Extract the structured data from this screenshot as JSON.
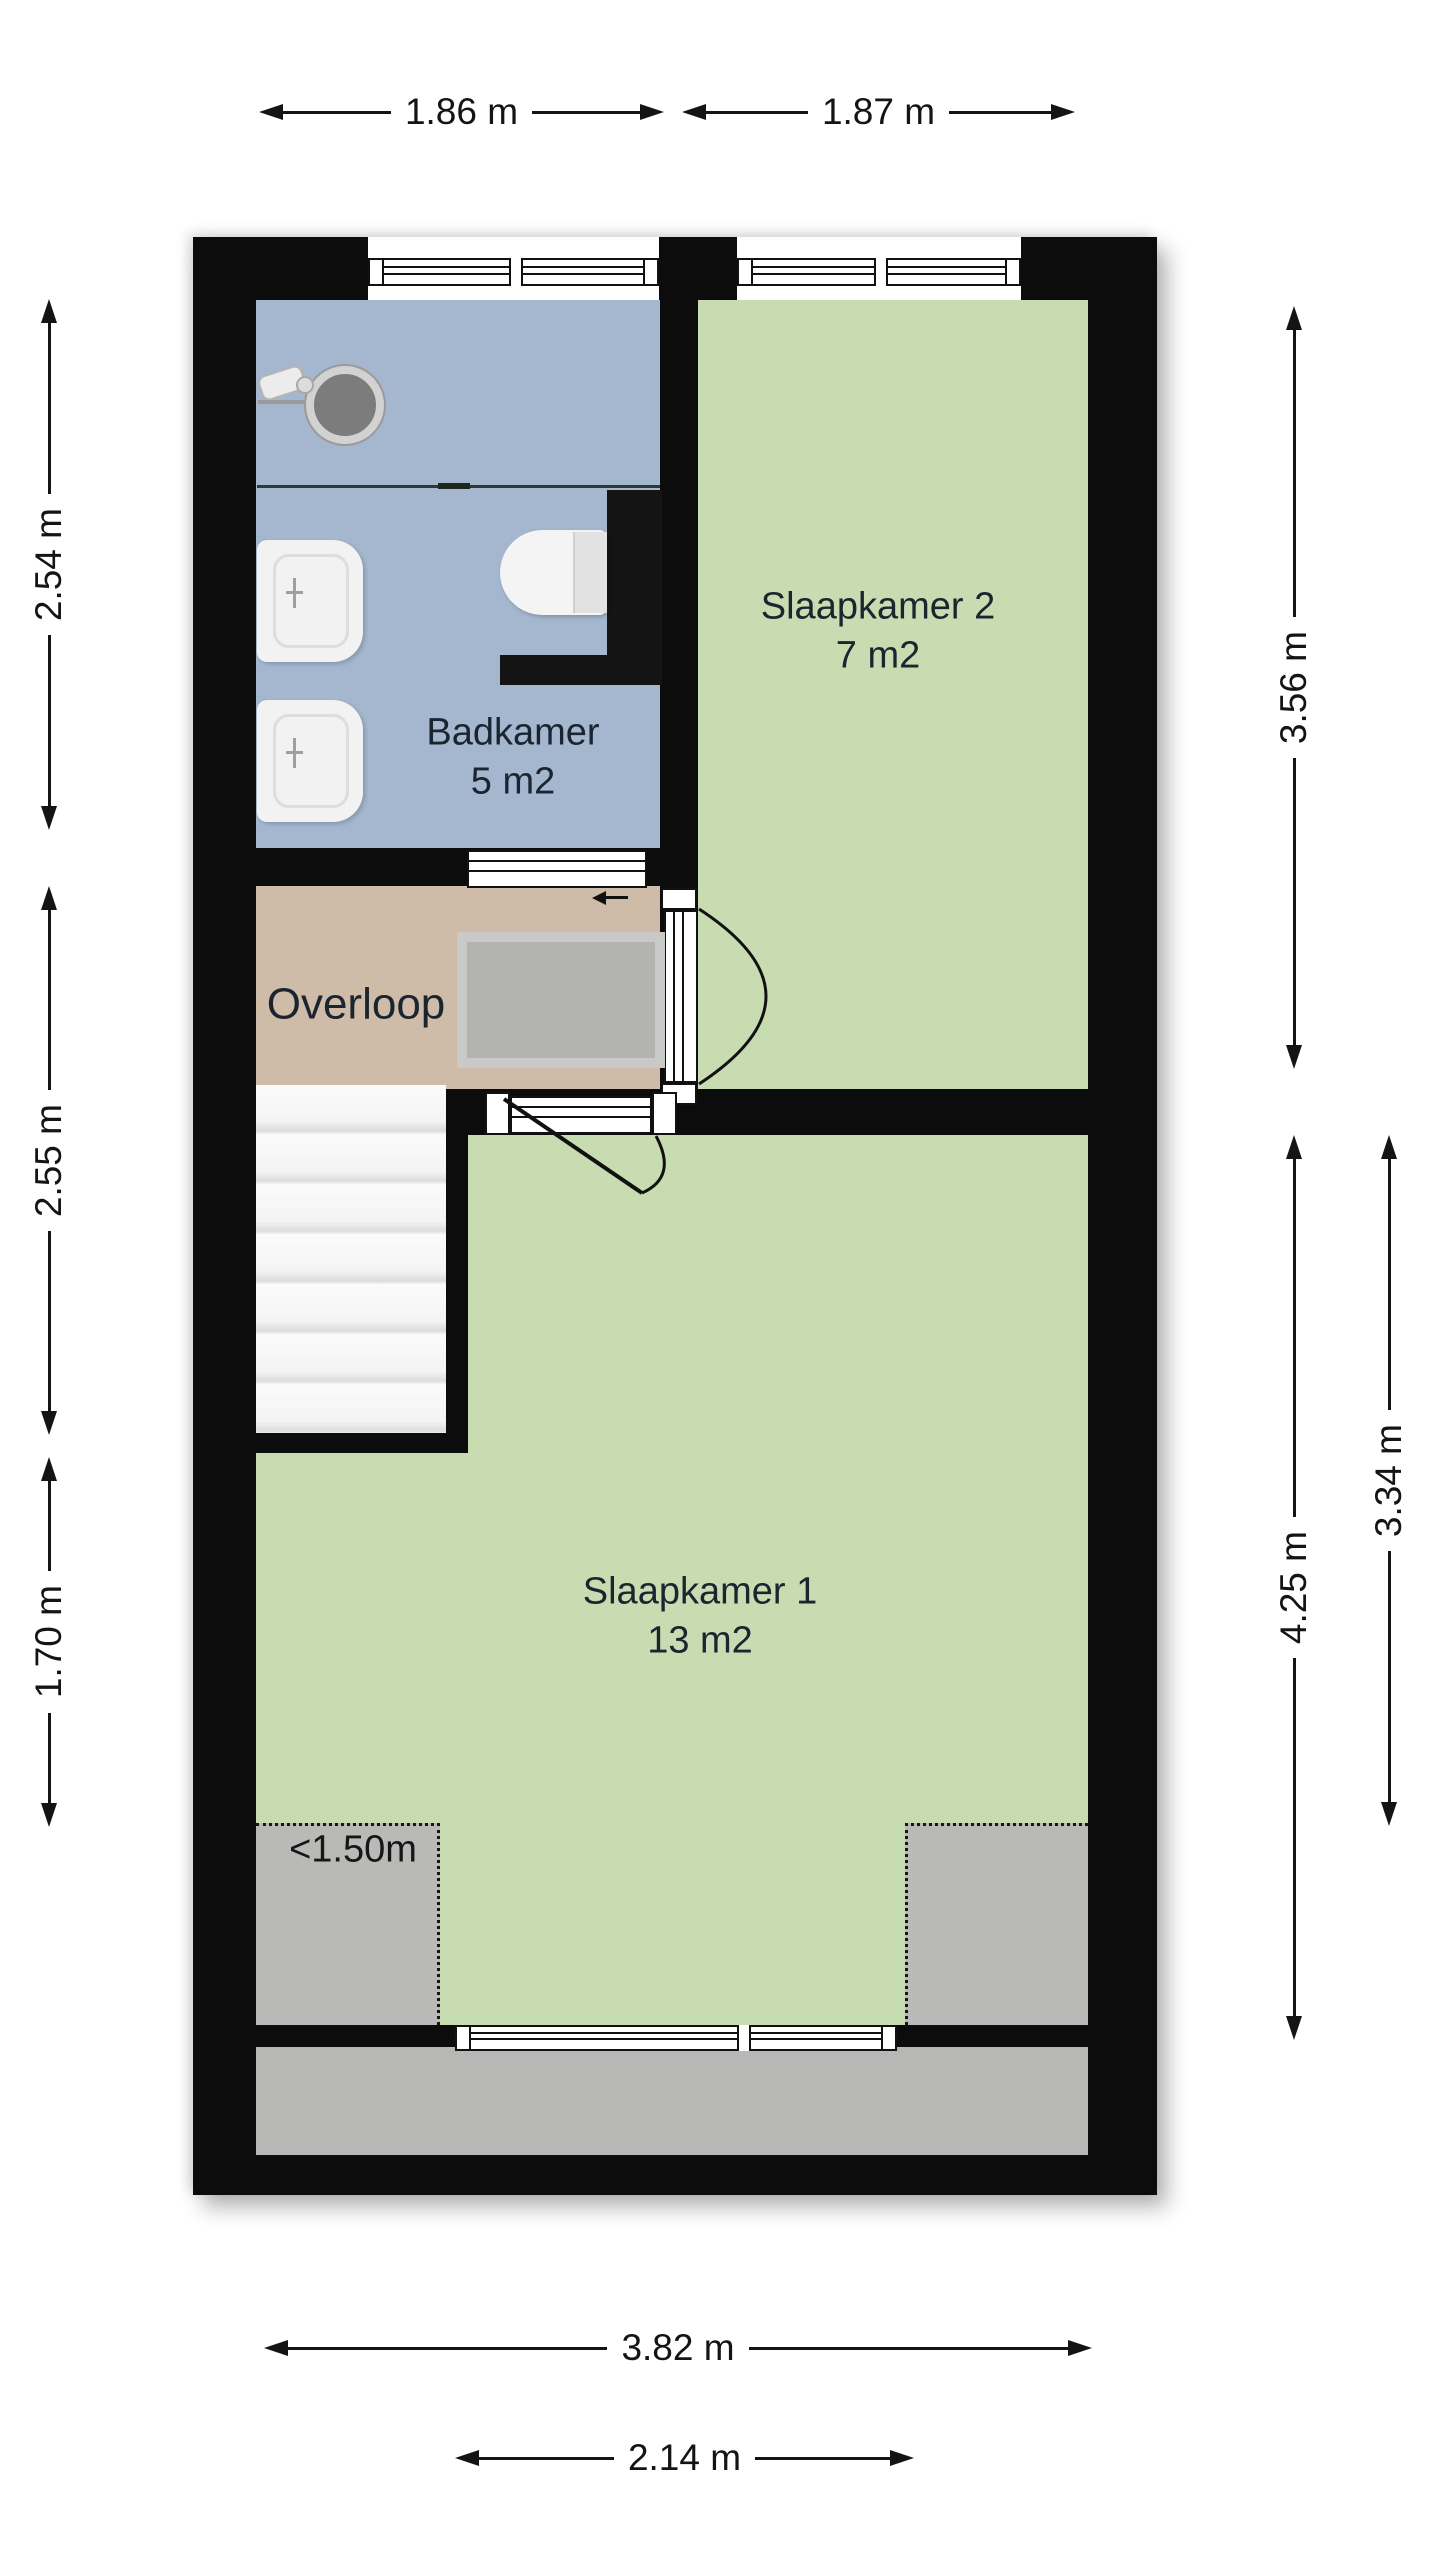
{
  "title": "Verdieping plattegrond",
  "rooms": {
    "badkamer": {
      "name": "Badkamer",
      "area": "5 m2"
    },
    "slaapkamer2": {
      "name": "Slaapkamer 2",
      "area": "7 m2"
    },
    "overloop": {
      "name": "Overloop"
    },
    "slaapkamer1": {
      "name": "Slaapkamer 1",
      "area": "13 m2"
    }
  },
  "annotations": {
    "low_headroom": "<1.50m"
  },
  "dimensions": {
    "top_left": "1.86 m",
    "top_right": "1.87 m",
    "left_upper": "2.54 m",
    "left_middle": "2.55 m",
    "left_lower": "1.70 m",
    "right_upper": "3.56 m",
    "right_inner": "4.25 m",
    "right_outer": "3.34 m",
    "bottom_outer": "3.82 m",
    "bottom_inner": "2.14 m"
  },
  "fixtures": [
    "shower",
    "shower-drain",
    "glass-screen",
    "sink",
    "sink",
    "toilet",
    "stairs",
    "stairwell-opening",
    "door-slaapkamer-2",
    "door-slaapkamer-1",
    "door-badkamer",
    "window",
    "window",
    "window"
  ],
  "colors": {
    "wall": "#0c0c0c",
    "bathroom_floor": "#a4b7cf",
    "bedroom_floor": "#c8dcb2",
    "landing_floor": "#cfbca8",
    "low_headroom_gray": "#b9b9b7",
    "label_text": "#1b2530"
  }
}
